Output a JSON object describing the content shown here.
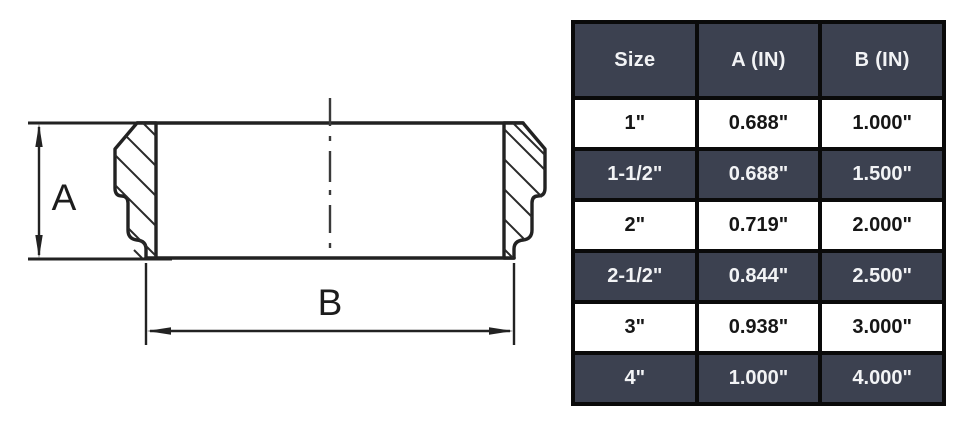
{
  "drawing": {
    "dimension_a_label": "A",
    "dimension_b_label": "B",
    "line_color": "#222222"
  },
  "table": {
    "columns": [
      "Size",
      "A (IN)",
      "B (IN)"
    ],
    "rows": [
      {
        "size": "1\"",
        "a_in": "0.688\"",
        "b_in": "1.000\""
      },
      {
        "size": "1-1/2\"",
        "a_in": "0.688\"",
        "b_in": "1.500\""
      },
      {
        "size": "2\"",
        "a_in": "0.719\"",
        "b_in": "2.000\""
      },
      {
        "size": "2-1/2\"",
        "a_in": "0.844\"",
        "b_in": "2.500\""
      },
      {
        "size": "3\"",
        "a_in": "0.938\"",
        "b_in": "3.000\""
      },
      {
        "size": "4\"",
        "a_in": "1.000\"",
        "b_in": "4.000\""
      }
    ],
    "colors": {
      "header_bg": "#3c4150",
      "dark_row_bg": "#3c4150",
      "light_row_bg": "#ffffff",
      "border": "#0a0a0a",
      "dark_text": "#f2f3f5",
      "light_text": "#161616"
    }
  }
}
